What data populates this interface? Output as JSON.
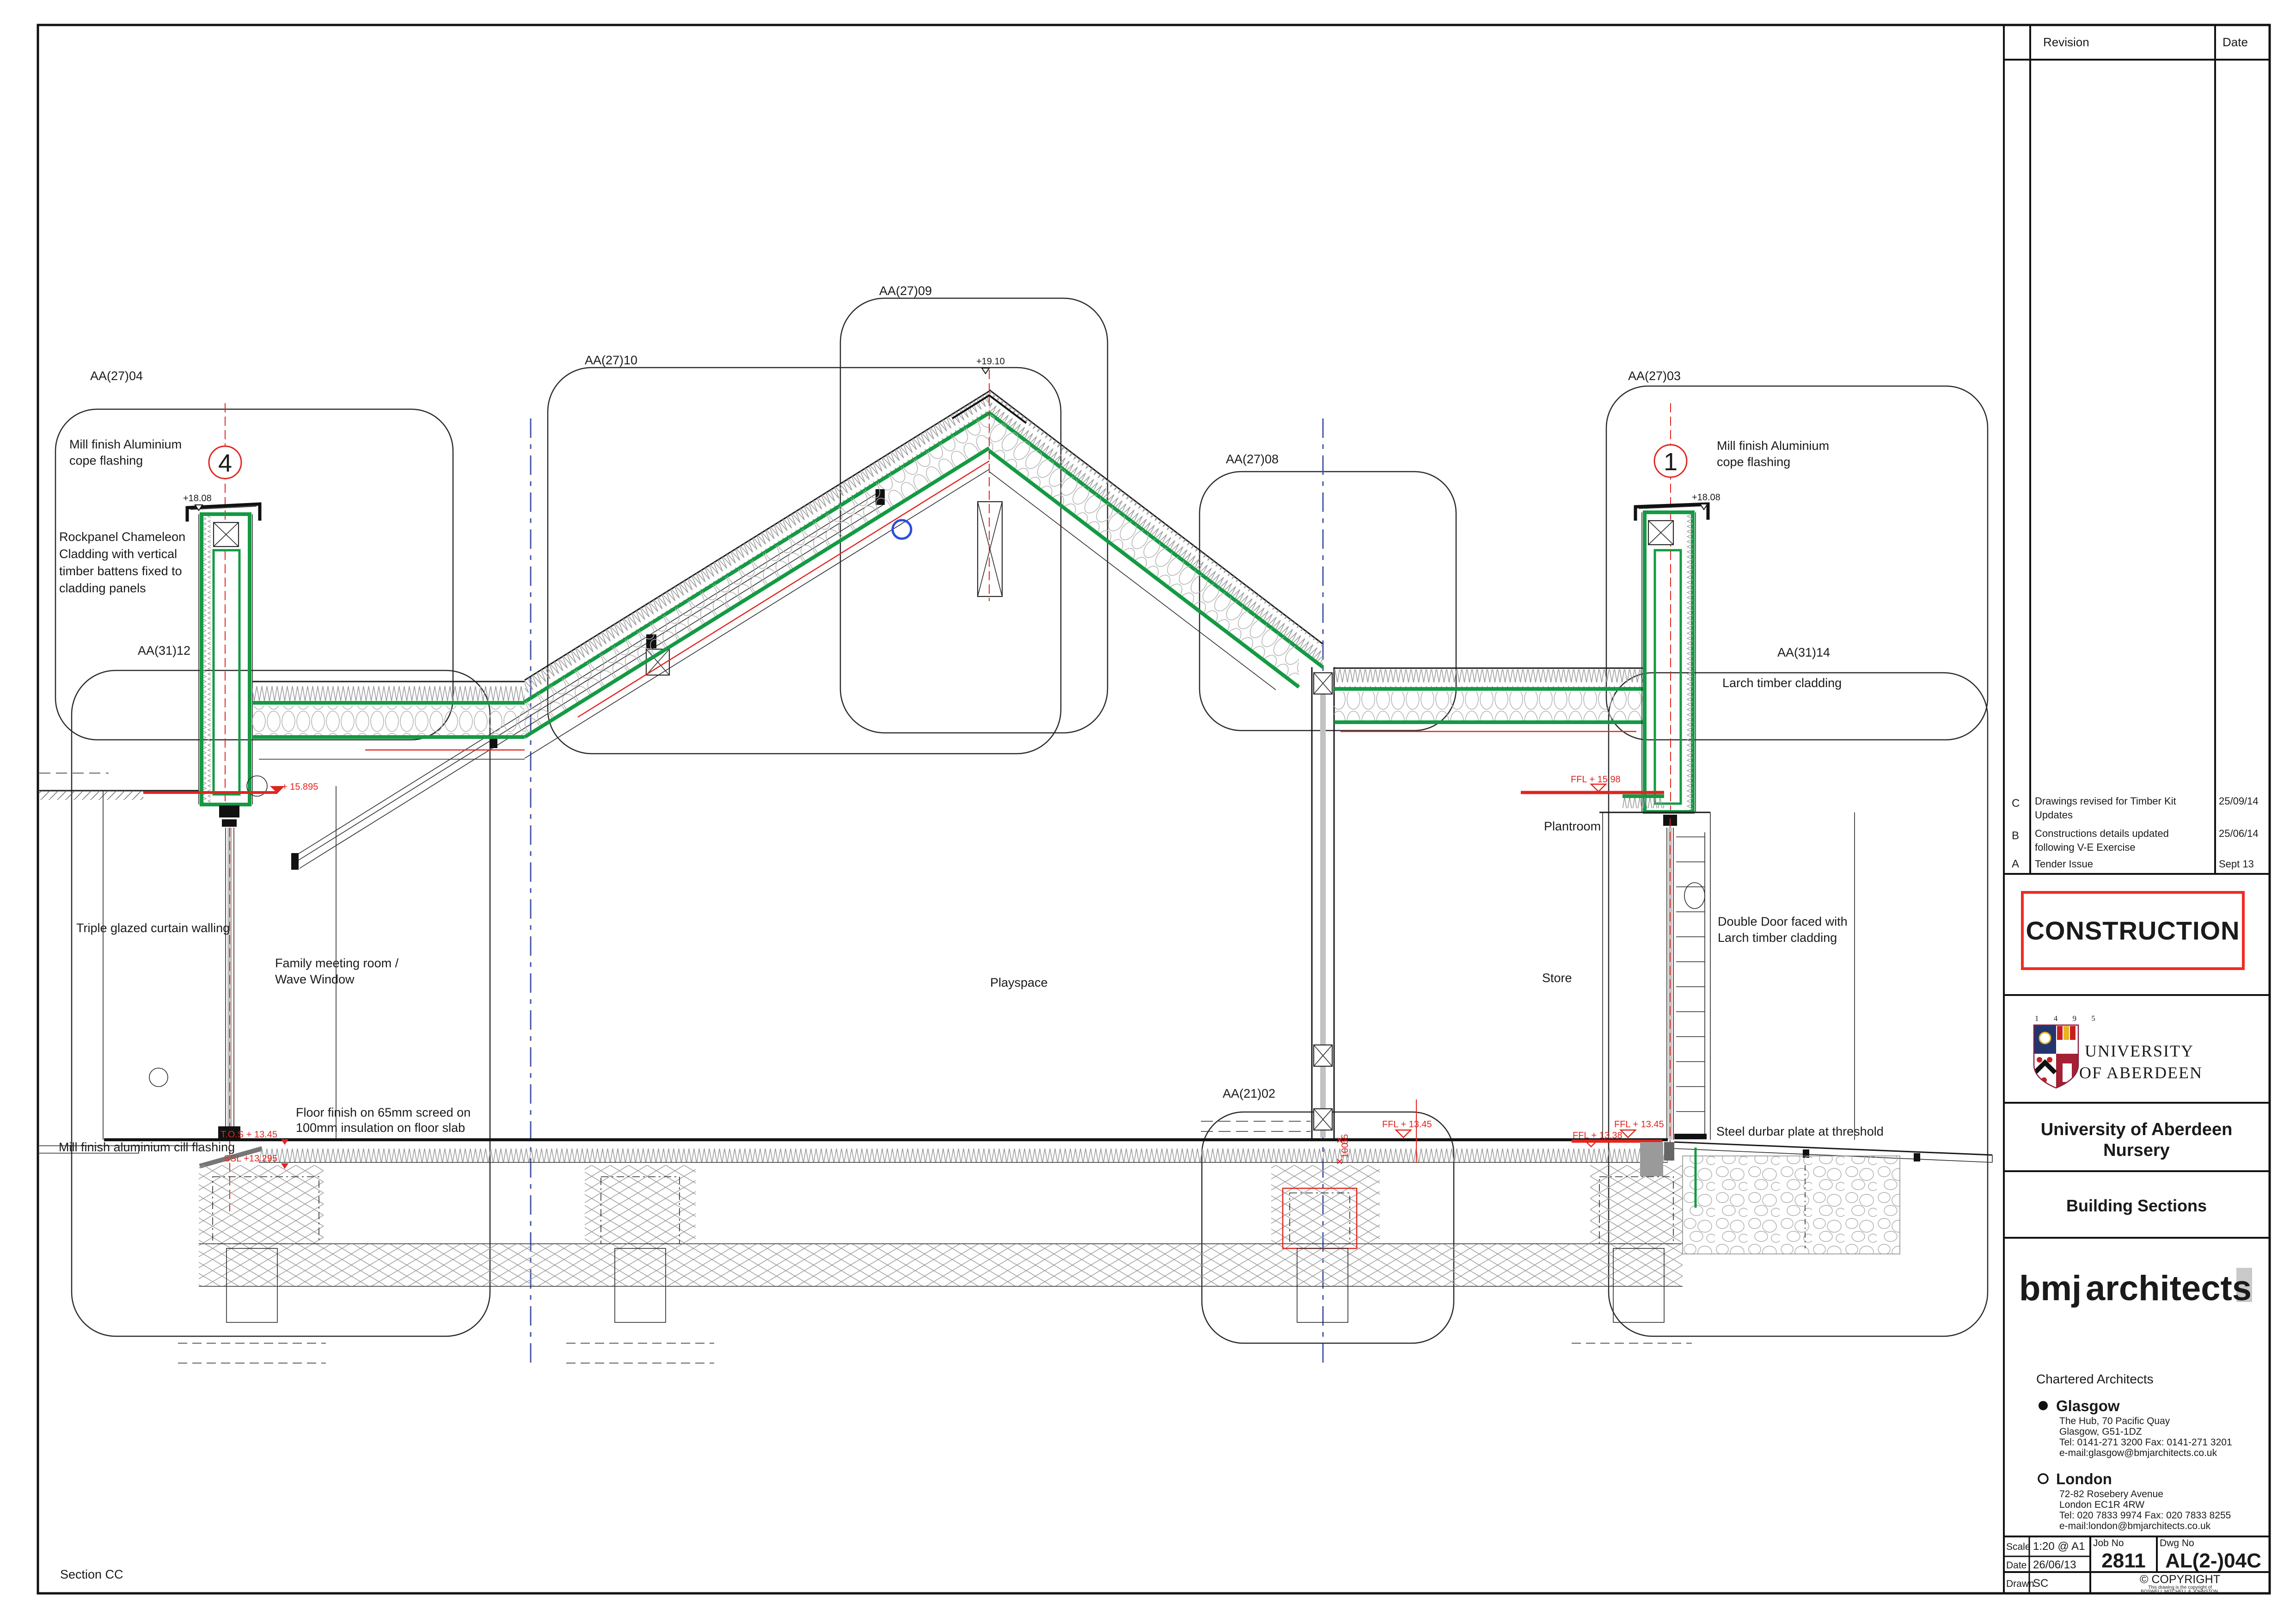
{
  "drawing": {
    "section_name": "Section CC",
    "labels": {
      "aa2704": "AA(27)04",
      "aa2710": "AA(27)10",
      "aa2709": "AA(27)09",
      "aa2708": "AA(27)08",
      "aa2703": "AA(27)03",
      "aa3112": "AA(31)12",
      "aa3114": "AA(31)14",
      "aa2102": "AA(21)02",
      "cope_left": [
        "Mill finish Aluminium",
        "cope flashing"
      ],
      "cope_right": [
        "Mill finish Aluminium",
        "cope flashing"
      ],
      "rockpanel": [
        "Rockpanel Chameleon",
        "Cladding with vertical",
        "timber battens fixed to",
        "cladding panels"
      ],
      "curtain": "Triple glazed curtain walling",
      "family": [
        "Family meeting room /",
        "Wave Window"
      ],
      "floor": [
        "Floor finish on 65mm screed on",
        "100mm insulation on floor slab"
      ],
      "cill": "Mill finish aluminium cill flashing",
      "playspace": "Playspace",
      "plantroom": "Plantroom",
      "store": "Store",
      "door": [
        "Double Door faced with",
        "Larch timber cladding"
      ],
      "larch": "Larch timber cladding",
      "durbar": "Steel durbar plate at threshold"
    },
    "levels": {
      "parapet_left": "+18.08",
      "parapet_right": "+18.08",
      "ridge": "+19.10",
      "eaves_left": "+ 15.895",
      "plantroom_ffl": "FFL + 15.98",
      "tos": "T.O.S + 13.45",
      "ssl": "SSL +13.295",
      "ffl_mid": "FFL + 13.45",
      "ffl_right": "FFL + 13.45",
      "ffl_right2": "FFL + 13.38",
      "dim_100": "100",
      "dim_65": "65"
    },
    "markers": {
      "left": "4",
      "right": "1"
    }
  },
  "titleblock": {
    "revision_header": "Revision",
    "date_header": "Date",
    "revisions": [
      {
        "letter": "C",
        "desc1": "Drawings revised for Timber Kit",
        "desc2": "Updates",
        "date": "25/09/14"
      },
      {
        "letter": "B",
        "desc1": "Constructions details updated",
        "desc2": "following V-E Exercise",
        "date": "25/06/14"
      },
      {
        "letter": "A",
        "desc1": "Tender Issue",
        "desc2": "",
        "date": "Sept 13"
      }
    ],
    "stamp": "CONSTRUCTION",
    "uoa": {
      "year": "1 4 9 5",
      "line1": "UNIVERSITY",
      "line2": "OF ABERDEEN"
    },
    "project": {
      "line1": "University of Aberdeen",
      "line2": "Nursery"
    },
    "drawing_title": "Building Sections",
    "firm": {
      "logo_red": "bmj",
      "logo_black": "architects",
      "subtitle": "Chartered Architects",
      "glasgow_name": "Glasgow",
      "glasgow_lines": [
        "The Hub, 70 Pacific Quay",
        "Glasgow, G51-1DZ",
        "Tel: 0141-271 3200 Fax: 0141-271 3201",
        "e-mail:glasgow@bmjarchitects.co.uk"
      ],
      "london_name": "London",
      "london_lines": [
        "72-82 Rosebery Avenue",
        "London EC1R 4RW",
        "Tel: 020 7833 9974  Fax: 020 7833 8255",
        "e-mail:london@bmjarchitects.co.uk"
      ]
    },
    "info": {
      "scale_label": "Scale",
      "scale": "1:20 @ A1",
      "date_label": "Date",
      "date": "26/06/13",
      "drawn_label": "Drawn",
      "drawn": "SC",
      "job_label": "Job No",
      "job": "2811",
      "dwg_label": "Dwg No",
      "dwg": "AL(2-)04C",
      "copyright": "© COPYRIGHT",
      "copyright_s1": "This drawing is the copyright of",
      "copyright_s2": "BOSWELL MITCHELL & JOHNSTON."
    },
    "colors": {
      "accent_green": "#149a43",
      "accent_red": "#e0251f",
      "grid_blue": "#4356a5",
      "uoa_maroon": "#87203f"
    }
  }
}
